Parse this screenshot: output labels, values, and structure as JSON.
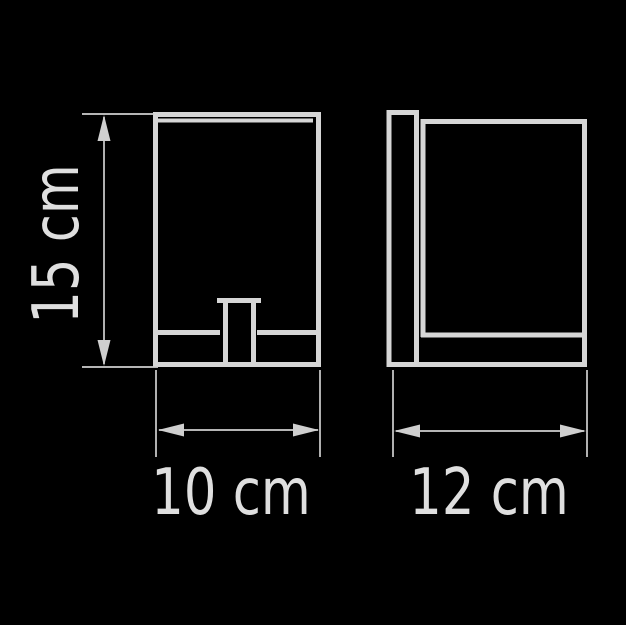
{
  "colors": {
    "background": "#000000",
    "outline": "#d6d6d6",
    "dimension": "#cfcfcf",
    "text": "#dfdfdf"
  },
  "drawing": {
    "kind": "technical-dimension-drawing",
    "views": [
      {
        "name": "front-view"
      },
      {
        "name": "side-view"
      }
    ],
    "dimensions": {
      "height": {
        "label": "15 cm",
        "value": 15,
        "unit": "cm",
        "orientation": "vertical"
      },
      "width": {
        "label": "10 cm",
        "value": 10,
        "unit": "cm",
        "orientation": "horizontal"
      },
      "depth": {
        "label": "12 cm",
        "value": 12,
        "unit": "cm",
        "orientation": "horizontal"
      }
    }
  }
}
